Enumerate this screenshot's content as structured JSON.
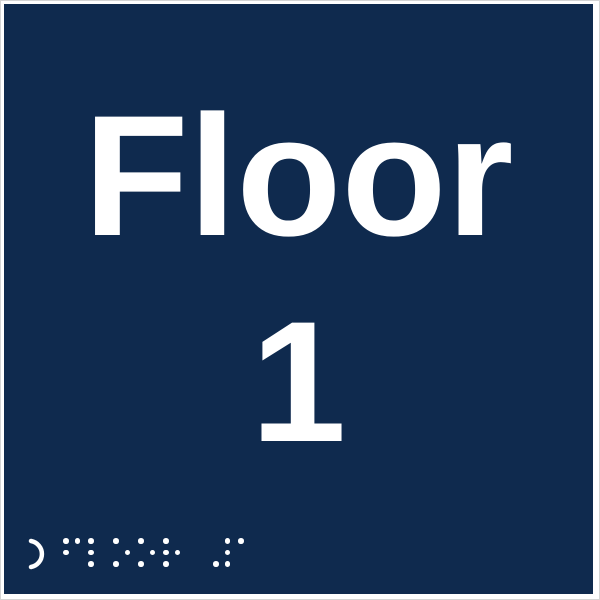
{
  "sign": {
    "title": "Floor",
    "floor_number": "1",
    "background_color": "#0f2a4e",
    "text_color": "#ffffff",
    "frame_color": "#ffffff",
    "edge_line_color": "#d4d4d4"
  },
  "braille": {
    "transcription": "floor 1",
    "locator_symbol": "crescent-arc-open-left",
    "cells": [
      {
        "char": "f",
        "dots": [
          1,
          2,
          4
        ]
      },
      {
        "char": "l",
        "dots": [
          1,
          2,
          3
        ]
      },
      {
        "char": "o",
        "dots": [
          1,
          3,
          5
        ]
      },
      {
        "char": "o",
        "dots": [
          1,
          3,
          5
        ]
      },
      {
        "char": "r",
        "dots": [
          1,
          2,
          3,
          5
        ]
      },
      {
        "char": "space",
        "dots": []
      },
      {
        "char": "number-sign",
        "dots": [
          3,
          4,
          5,
          6
        ]
      },
      {
        "char": "a",
        "dots": [
          1
        ]
      }
    ],
    "layout": {
      "cell_pitch_px": 25,
      "dot_pitch_px": 11.5,
      "dot_diameter_px": 5.5
    }
  }
}
